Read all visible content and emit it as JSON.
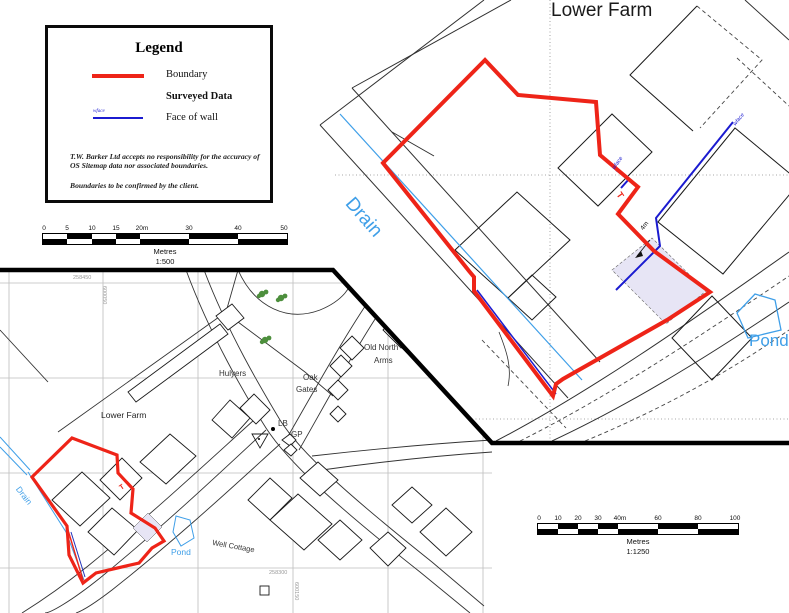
{
  "detail_map": {
    "title": "Lower Farm",
    "drain_label": "Drain",
    "pond_label": "Pond",
    "wface1": "wface",
    "wface2": "wface",
    "dim_4m": "4m",
    "tee": "T"
  },
  "overview_map": {
    "lower_farm": "Lower Farm",
    "hulyers": "Hulyers",
    "old_north": "Old North",
    "arms": "Arms",
    "oak": "Oak",
    "gates": "Gates",
    "lb": "LB",
    "gp": "GP",
    "well_cottage": "Well Cottage",
    "pond": "Pond",
    "drain": "Drain",
    "tee": "T",
    "northing_top": "258450",
    "northing_bottom": "258300",
    "easting_top": "600050",
    "easting_bottom": "600150"
  },
  "legend": {
    "title": "Legend",
    "boundary_label": "Boundary",
    "surveyed_label": "Surveyed Data",
    "face_of_wall_label": "Face of wall",
    "wface_tag": "wface",
    "disclaimer1": "T.W. Barker Ltd accepts no responsibility for the accuracy of OS Sitemap data nor associated boundaries.",
    "disclaimer2": "Boundaries to be confirmed by the client."
  },
  "scale500": {
    "ticks": [
      "0",
      "5",
      "10",
      "15",
      "20m",
      "30",
      "40",
      "50"
    ],
    "caption": "Metres",
    "ratio": "1:500"
  },
  "scale1250": {
    "ticks": [
      "0",
      "10",
      "20",
      "30",
      "40m",
      "60",
      "80",
      "100"
    ],
    "caption": "Metres",
    "ratio": "1:1250"
  },
  "colors": {
    "boundary_red": "#ee2418",
    "wall_blue": "#1b1bd0",
    "water_cyan": "#3f9fe8",
    "building_fill_purple": "#e7e5f5",
    "tree_green": "#4d8f3d",
    "grid_gray": "#bdbdbd"
  }
}
